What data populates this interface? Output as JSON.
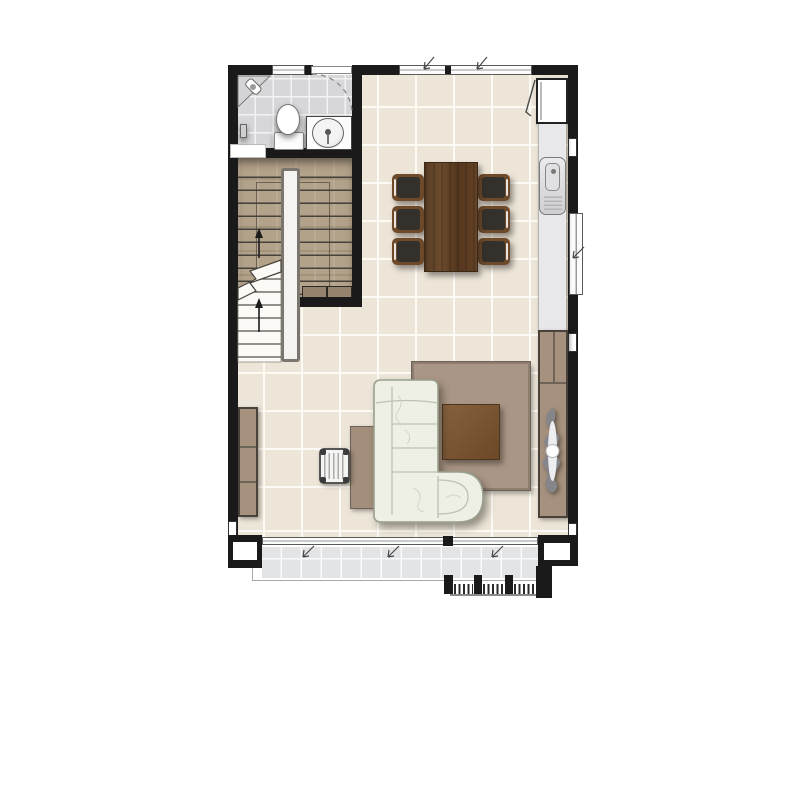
{
  "plan": {
    "type": "residential-floor-plan",
    "view": "top-down",
    "rooms": [
      {
        "id": "bathroom",
        "label": "bathroom",
        "features": [
          "toilet",
          "washbasin-vanity",
          "corner-shelf",
          "wall-tap",
          "swing-door"
        ]
      },
      {
        "id": "staircase",
        "label": "u-shaped-staircase",
        "features": [
          "upper-flight-wood",
          "lower-flight",
          "break-line",
          "direction-arrows-up",
          "under-stair-cabinet"
        ]
      },
      {
        "id": "dining-area",
        "label": "dining-area",
        "features": [
          "dining-table",
          "six-dining-chairs"
        ]
      },
      {
        "id": "kitchen",
        "label": "kitchen-strip",
        "features": [
          "refrigerator",
          "counter",
          "sink",
          "casement-window"
        ]
      },
      {
        "id": "living-area",
        "label": "living-area",
        "features": [
          "l-shaped-sofa",
          "rug",
          "coffee-table",
          "sideboard-with-ornament",
          "desk",
          "striped-chair",
          "low-cabinet"
        ]
      },
      {
        "id": "terrace",
        "label": "terrace",
        "features": [
          "sliding-glass-doors",
          "tiled-deck",
          "entry-steps"
        ]
      }
    ],
    "items": {
      "sofa": "l-shaped-sofa",
      "rug": "area-rug",
      "coffee_table": "coffee-table",
      "dining_table": "dining-table",
      "dining_chair": "dining-chair",
      "refrigerator": "refrigerator",
      "counter": "kitchen-counter",
      "sink": "kitchen-sink",
      "sideboard": "sideboard",
      "ornament": "decorative-ornament",
      "desk": "console-desk",
      "stool": "striped-chair",
      "left_cabinet": "low-cabinet",
      "toilet": "toilet",
      "basin": "round-washbasin",
      "stairs": "u-shaped-staircase",
      "terrace": "terrace-deck",
      "sliding_door": "sliding-glass-door",
      "bath_door": "bathroom-swing-door"
    },
    "counts": {
      "dining_chairs": 6,
      "sofa_seats": 3,
      "terrace_step_bays": 3
    },
    "palette": {
      "wall": "#1a1a1a",
      "floor_tile": "#ece5d8",
      "grout": "#fdfbf5",
      "bath_tile": "#d7d7d9",
      "terrace_tile": "#e3e4e6",
      "stair_wood": "#b3a28a",
      "table_wood": "#5d4027",
      "chair_seat": "#34302b",
      "chair_frame": "#6e4a2a",
      "taupe_furniture": "#a5917d",
      "rug": "#a99686",
      "coffee_table": "#7b5433",
      "sofa": "#eef0e6",
      "counter": "#e8e7e9",
      "fixture_white": "#ffffff"
    }
  }
}
